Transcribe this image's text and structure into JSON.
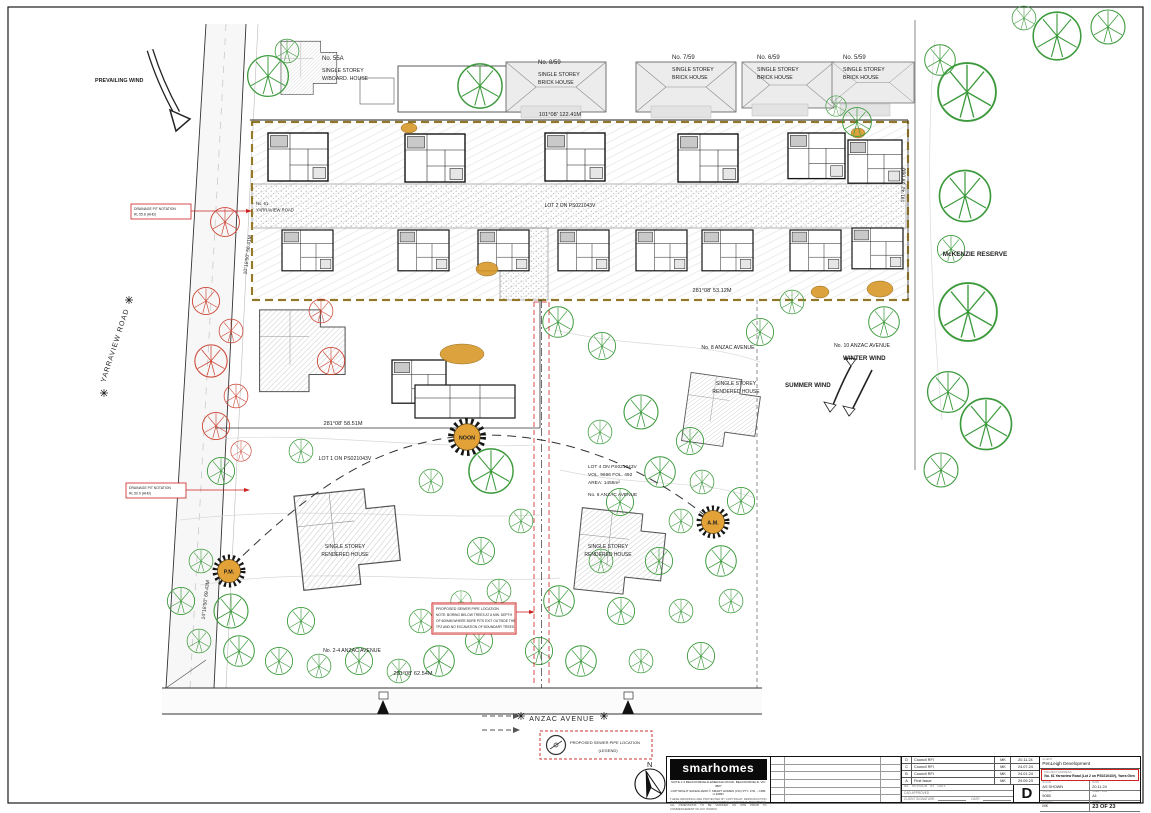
{
  "sheet": {
    "compass_n": "N",
    "title_block": {
      "logo_text": "smarhomes",
      "logo_sub1": "SUITE 1-3 BEACONSFIELD-EMERALD ROAD, BEACONSFIELD, VIC 3807",
      "logo_sub2": "COPYRIGHT SAFEGUARD © SMART HOMES (VIC) PTY. LTD. - CDB-U 49897",
      "logo_fineprint": "THESE DRAWINGS ARE PROTECTED BY COPYRIGHT. REPRODUCTION IN WHOLE OR IN PART WITHOUT WRITTEN CONSENT IS PROHIBITED. ALL DIMENSIONS TO BE VERIFIED ON SITE PRIOR TO COMMENCEMENT OF ANY WORKS.",
      "header_no": "No.",
      "header_revision": "REVISION",
      "header_by": "BY",
      "header_date": "DATE",
      "revisions": [
        {
          "rev": "D",
          "desc": "Council RFI",
          "by": "MK",
          "date": "20.11.24"
        },
        {
          "rev": "C",
          "desc": "Council RFI",
          "by": "MK",
          "date": "24.07.24"
        },
        {
          "rev": "B",
          "desc": "Council RFI",
          "by": "MK",
          "date": "24.01.24"
        },
        {
          "rev": "A",
          "desc": "First Issue",
          "by": "MK",
          "date": "29.09.23"
        }
      ],
      "cad_approved_label": "CAD APPROVED",
      "client_signature_label": "CLIENT SIGNATURE",
      "sig_date_label": "DATE",
      "current_revision": "D",
      "client_label": "CLIENT",
      "client_name": "PenLeigh Development",
      "project_label": "PROJECT ADDRESS",
      "project_address": "No. 61 Yarraview Road (Lot 2 on PS021043V), Yarra Glen",
      "scale_label": "SCALE",
      "scale_value": "AS SHOWN",
      "date_label": "DATE",
      "date_value": "20.11.24",
      "job_label": "JOB No.",
      "job_value": "5080",
      "sheet_size_label": "SHEET SIZE",
      "sheet_size_value": "A1",
      "drawn_label": "DRAWN",
      "drawn_value": "MK",
      "sheet_label": "SHEET",
      "sheet_value": "23 OF 23"
    }
  },
  "plan": {
    "neighbors": [
      {
        "no": "No. 55A",
        "l1": "SINGLE STOREY",
        "l2": "W/BOARD. HOUSE"
      },
      {
        "no": "No. 8/59",
        "l1": "SINGLE STOREY",
        "l2": "BRICK HOUSE"
      },
      {
        "no": "No. 7/59",
        "l1": "SINGLE STOREY",
        "l2": "BRICK HOUSE"
      },
      {
        "no": "No. 6/59",
        "l1": "SINGLE STOREY",
        "l2": "BRICK HOUSE"
      },
      {
        "no": "No. 5/59",
        "l1": "SINGLE STOREY",
        "l2": "BRICK HOUSE"
      }
    ],
    "dimensions": {
      "top": "101°08' 122.41M",
      "mid_upper": "281°08' 53.12M",
      "mid_lower": "281°08' 58.51M",
      "bottom": "281°08' 62.54M",
      "left_upper": "10°18'50\" 56.41M",
      "left_lower": "14°18'50\" 69.43M",
      "right": "191°42' 29.06M"
    },
    "roads": {
      "yarraview": "YARRAVIEW ROAD",
      "anzac": "ANZAC AVENUE",
      "no61_l1": "No. 61",
      "no61_l2": "YARRAVIEW ROAD"
    },
    "winds": {
      "prevailing": "PREVAILING WIND",
      "summer": "SUMMER WIND",
      "winter": "WINTER WIND"
    },
    "reserve": "McKENZIE RESERVE",
    "lots": {
      "lot2": "LOT 2 ON PS021043V",
      "lot1": "LOT 1 ON PS021043V",
      "lot4_l1": "LOT 4 ON PS021043V",
      "lot4_l2": "VOL. 9666 FOL. 492",
      "lot4_l3": "AREA: 1456m²",
      "lot4_l4": "No. 6 ANZAC AVENUE"
    },
    "addresses": {
      "no8": "No. 8 ANZAC AVENUE",
      "no10": "No. 10 ANZAC AVENUE",
      "no24": "No. 2-4 ANZAC AVENUE"
    },
    "existing_houses": {
      "l1": "SINGLE STOREY",
      "l2": "RENDERED HOUSE"
    },
    "suns": {
      "noon": "NOON",
      "am": "A.M.",
      "pm": "P.M."
    },
    "red_notes": {
      "drain1_l1": "DRAINAGE PIT NOTATION",
      "drain1_l2": "RL 55.8 (AHD)",
      "drain2_l1": "DRAINAGE PIT NOTATION",
      "drain2_l2": "RL 50.9 (AHD)",
      "sewer_l1": "PROPOSED SEWER PIPE LOCATION",
      "sewer_l2": "NOTE: BORING BELOW TREES AT A MIN. DEPTH",
      "sewer_l3": "OF 600MM WHERE BORE PITS EXIT OUTSIDE THE",
      "sewer_l4": "TPZ AND NO EXCAVATION OF BOUNDARY TREES"
    },
    "legend": {
      "l1": "PROPOSED SEWER PIPE LOCATION",
      "l2": "(LEGEND)"
    }
  },
  "colors": {
    "tree_green": "#3c9a3c",
    "removed_tree_red": "#cc4433",
    "annotation_red": "#cc2222",
    "sun_orange": "#e2a238",
    "boundary_gold": "#c8a028",
    "road_gray": "#ececec"
  }
}
